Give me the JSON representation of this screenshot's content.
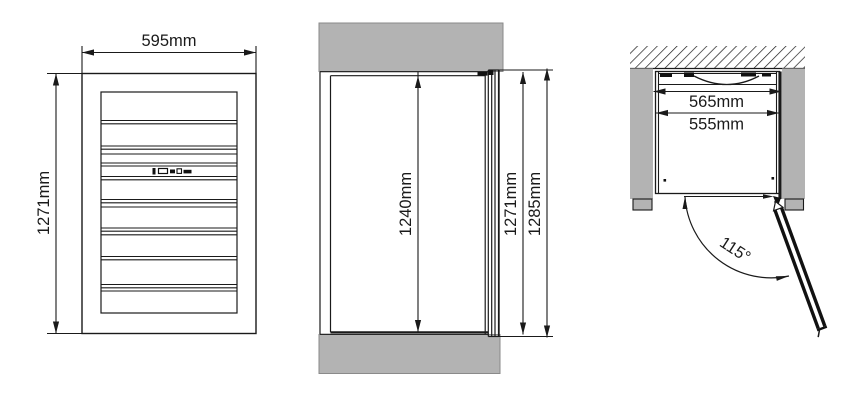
{
  "drawing": {
    "front_view": {
      "width_label": "595mm",
      "height_label": "1271mm"
    },
    "side_view": {
      "recess_height_label": "1240mm",
      "unit_height_label": "1271mm",
      "overall_height_label": "1285mm"
    },
    "top_view": {
      "recess_width_label": "565mm",
      "unit_width_label": "555mm",
      "door_angle_label": "115°"
    },
    "colors": {
      "line": "#1a1a1a",
      "shading": "#b3b3b3",
      "background": "#ffffff"
    }
  }
}
